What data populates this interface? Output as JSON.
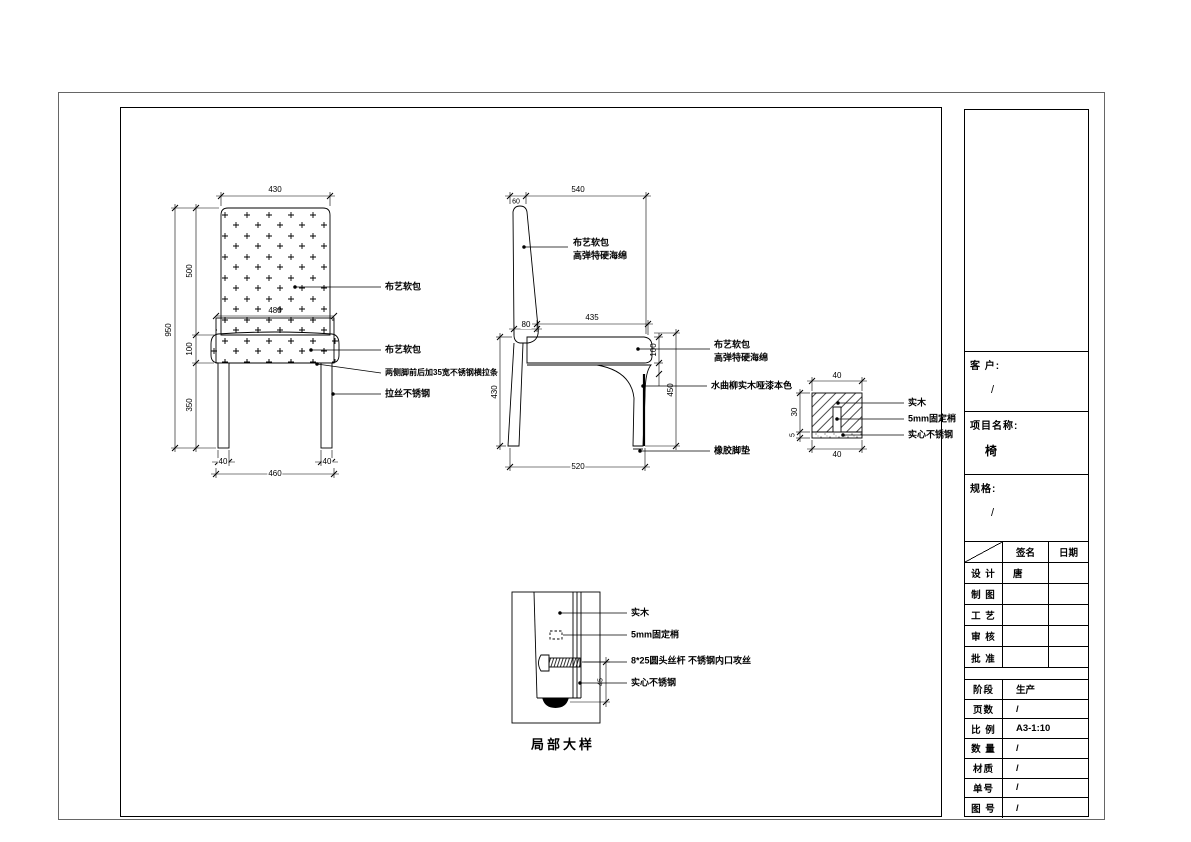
{
  "front_view": {
    "dim_top_width": "430",
    "dim_overall_height": "950",
    "dim_back_height": "500",
    "dim_seat_thickness": "100",
    "dim_leg_height": "350",
    "dim_seat_width": "480",
    "dim_leg_w_left": "40",
    "dim_leg_w_right": "40",
    "dim_base_width": "460",
    "label_back_upholstery": "布艺软包",
    "label_seat_upholstery": "布艺软包",
    "label_stretcher": "两侧脚前后加35宽不锈钢横拉条",
    "label_leg_material": "拉丝不锈钢"
  },
  "side_view": {
    "dim_top_depth": "540",
    "dim_back_top_thickness": "60",
    "dim_seat_depth": "435",
    "dim_back_bottom_thickness": "80",
    "dim_seat_cushion": "100",
    "dim_seat_height": "450",
    "dim_underseat_height": "430",
    "dim_base_depth": "520",
    "label_back_line1": "布艺软包",
    "label_back_line2": "高弹特硬海绵",
    "label_seat_line1": "布艺软包",
    "label_seat_line2": "高弹特硬海绵",
    "label_leg_wood": "水曲柳实木哑漆本色",
    "label_foot_pad": "橡胶脚垫"
  },
  "section_detail": {
    "dim_width_top": "40",
    "dim_width_bottom": "40",
    "dim_height": "30",
    "dim_plate": "5",
    "label_wood": "实木",
    "label_pin": "5mm固定梢",
    "label_steel": "实心不锈钢"
  },
  "leg_detail": {
    "title": "局部大样",
    "dim_side": "45",
    "label_wood": "实木",
    "label_pin": "5mm固定梢",
    "label_screw": "8*25圆头丝杆 不锈钢内口攻丝",
    "label_steel": "实心不锈钢"
  },
  "title_block": {
    "customer_label": "客 户:",
    "customer_value": "/",
    "project_label": "项目名称:",
    "project_value": "椅",
    "spec_label": "规格:",
    "spec_value": "/",
    "sign_header": "签名",
    "date_header": "日期",
    "sign_rows": [
      {
        "label": "设 计",
        "sign": "唐",
        "date": ""
      },
      {
        "label": "制 图",
        "sign": "",
        "date": ""
      },
      {
        "label": "工 艺",
        "sign": "",
        "date": ""
      },
      {
        "label": "审 核",
        "sign": "",
        "date": ""
      },
      {
        "label": "批 准",
        "sign": "",
        "date": ""
      }
    ],
    "info_rows": [
      {
        "label": "阶段",
        "value": "生产"
      },
      {
        "label": "页数",
        "value": "/"
      },
      {
        "label": "比 例",
        "value": "A3-1:10"
      },
      {
        "label": "数 量",
        "value": "/"
      },
      {
        "label": "材质",
        "value": "/"
      },
      {
        "label": "单号",
        "value": "/"
      },
      {
        "label": "图 号",
        "value": "/"
      }
    ]
  }
}
